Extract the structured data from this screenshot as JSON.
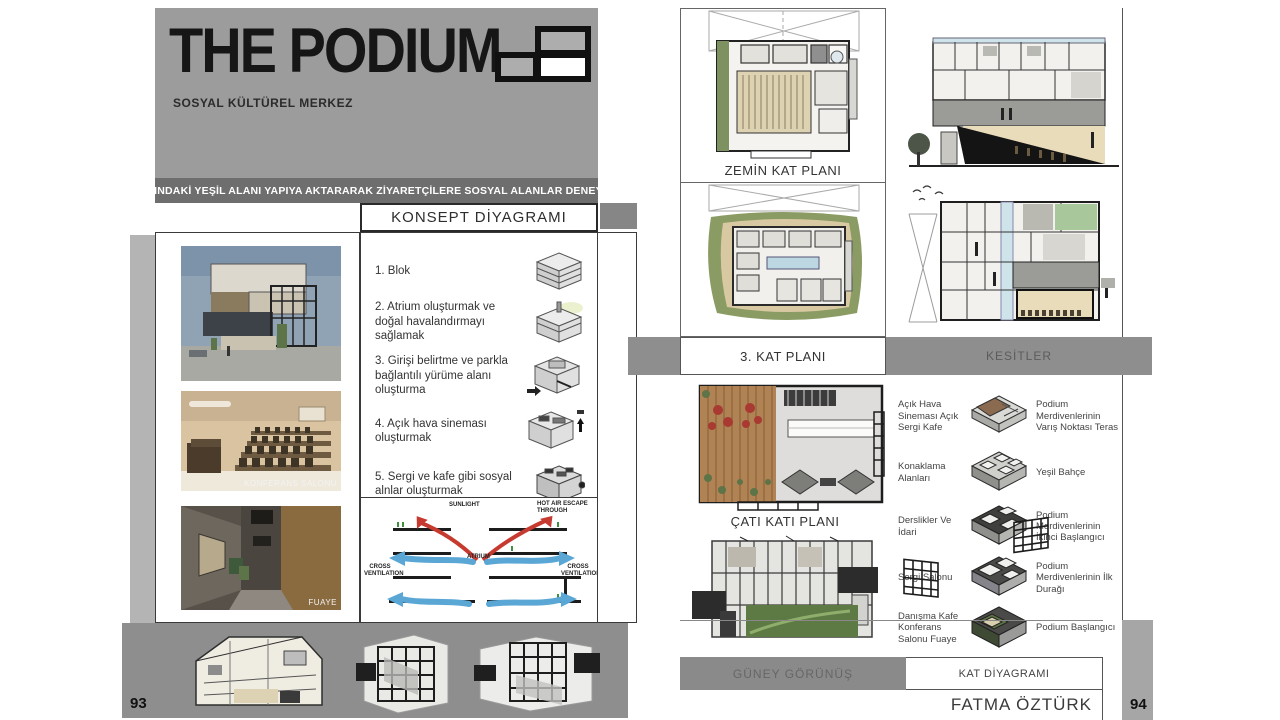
{
  "page_left": {
    "page_number": "93",
    "title": "THE PODIUM",
    "subtitle": "SOSYAL KÜLTÜREL MERKEZ",
    "tagline": "FATİH PARKINDAKİ YEŞİL ALANI YAPIYA AKTARARAK ZİYARETÇİLERE SOSYAL ALANLAR DENEYİMLETMEK.",
    "concept": {
      "header": "KONSEPT DİYAGRAMI",
      "items": [
        {
          "label": "1. Blok"
        },
        {
          "label": "2. Atrium oluşturmak ve doğal havalandırmayı sağlamak"
        },
        {
          "label": "3. Girişi belirtme ve parkla bağlantılı yürüme alanı oluşturma"
        },
        {
          "label": "4. Açık hava sineması oluşturmak"
        },
        {
          "label": "5. Sergi ve kafe gibi sosyal alnlar oluşturmak"
        }
      ]
    },
    "photos": [
      {
        "caption": ""
      },
      {
        "caption": "KONFERANS SALONU"
      },
      {
        "caption": "FUAYE"
      }
    ],
    "ventilation": {
      "sunlight": "SUNLIGHT",
      "hot_air": "HOT AIR ESCAPE THROUGH",
      "atrium": "ATRIUM",
      "cross_left": "CROSS VENTILATION",
      "cross_right": "CROSS VENTILATION"
    }
  },
  "page_right": {
    "page_number": "94",
    "author": "FATMA ÖZTÜRK",
    "captions": {
      "ground_plan": "ZEMİN KAT PLANI",
      "third_plan": "3. KAT PLANI",
      "sections": "KESİTLER",
      "roof_plan": "ÇATI KATI PLANI",
      "south_elevation": "GÜNEY GÖRÜNÜŞ",
      "floor_diagram": "KAT DİYAGRAMI"
    },
    "legend": [
      {
        "left": "Açık Hava Sineması Açık Sergi Kafe",
        "right": "Podium Merdivenlerinin Varış Noktası Teras"
      },
      {
        "left": "Konaklama Alanları",
        "right": "Yeşil Bahçe"
      },
      {
        "left": "Derslikler Ve İdari",
        "right": "Podium Merdivenlerinin İkinci Başlangıcı"
      },
      {
        "left": "Sergi Salonu",
        "right": "Podium Merdivenlerinin İlk Durağı"
      },
      {
        "left": "Danışma Kafe Konferans Salonu Fuaye",
        "right": "Podium Başlangıcı"
      }
    ]
  },
  "colors": {
    "title_block": "#9c9c9c",
    "tagline_band": "#6e6e6e",
    "gray_band": "#8e8e8e",
    "accent_red_arrow": "#c63a30",
    "accent_blue_arrow": "#5aa7d6",
    "green_landscape": "#8a9b63",
    "wood_deck": "#b08355"
  }
}
